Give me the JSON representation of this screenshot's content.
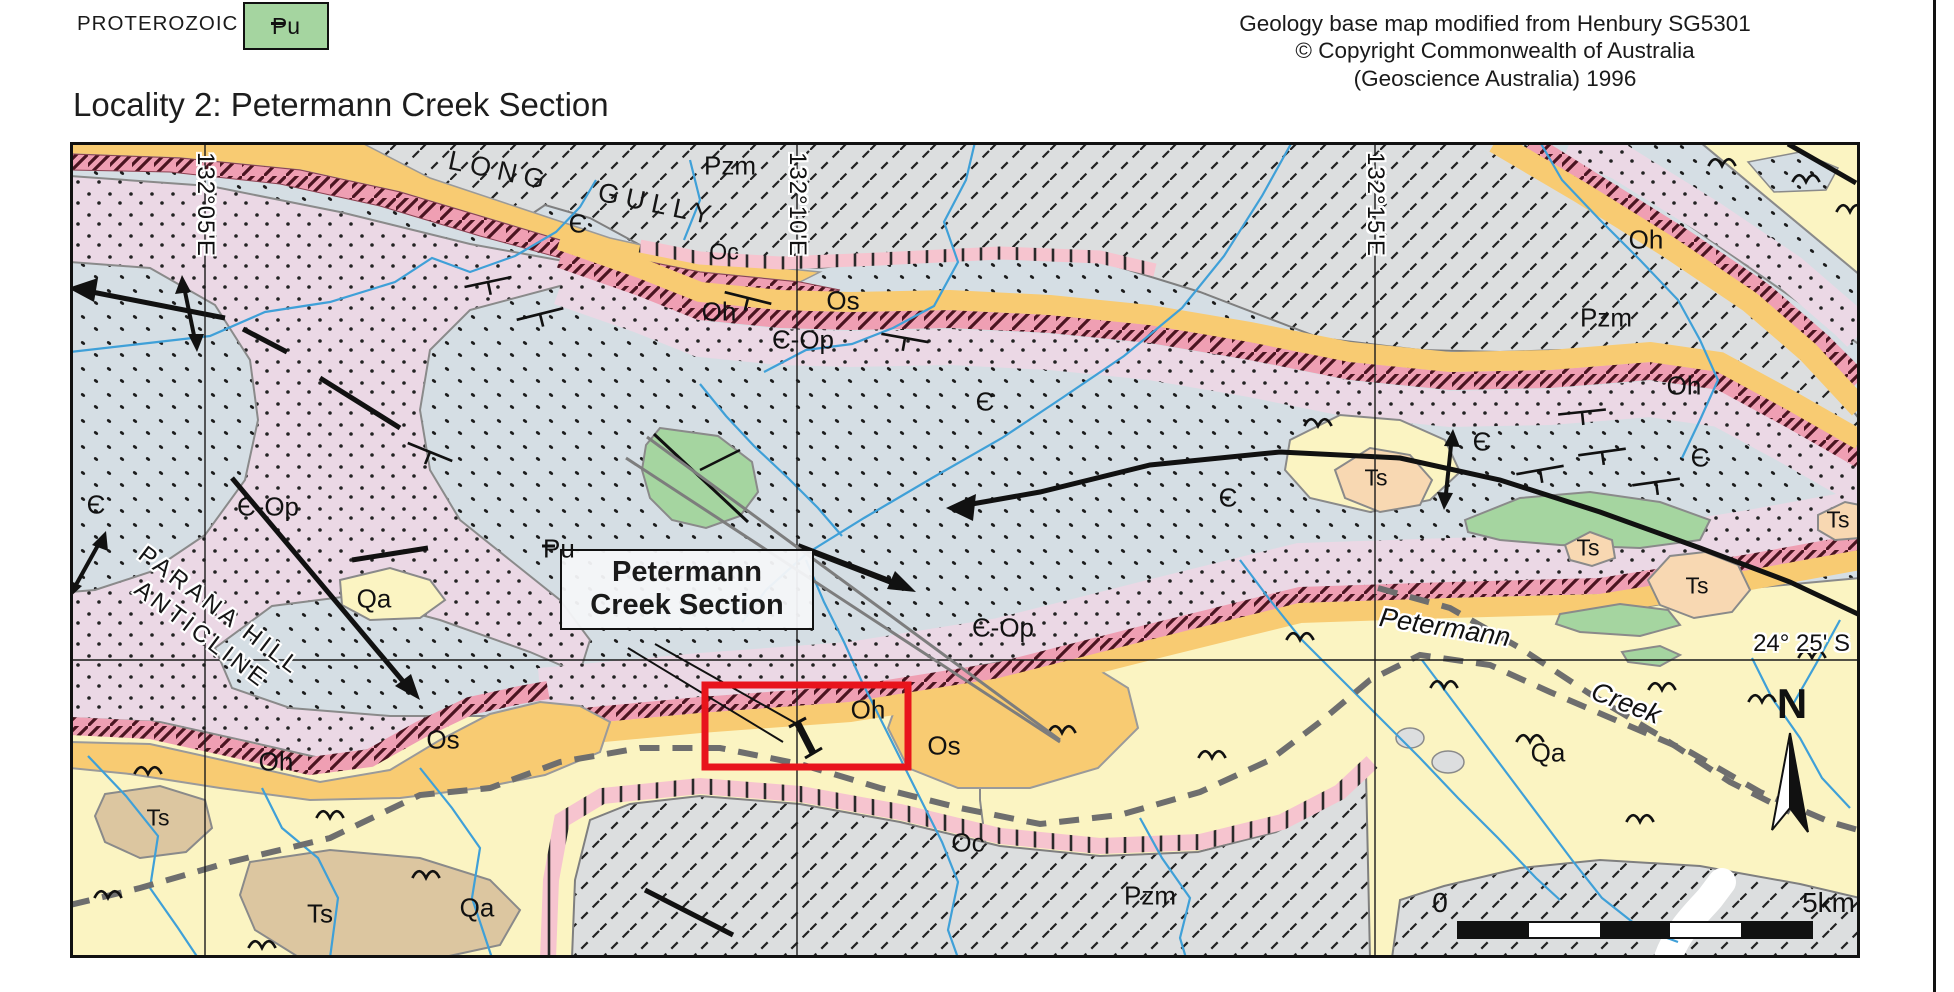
{
  "legend": {
    "era_label": "PROTEROZOIC",
    "unit_code": "Pu"
  },
  "attribution": {
    "line1": "Geology base map modified from Henbury SG5301",
    "line2": "© Copyright Commonwealth of Australia",
    "line3": "(Geoscience Australia) 1996"
  },
  "title": "Locality 2: Petermann Creek Section",
  "map": {
    "grid": {
      "lon1": "132°05'E",
      "lon2": "132°10'E",
      "lon3": "132°15'E",
      "lat1": "24° 25' S"
    },
    "place_names": {
      "long_gully": "LONG GULLY",
      "anticline_line1": "PARANA HILL",
      "anticline_line2": "ANTICLINE",
      "creek_name_1": "Petermann",
      "creek_name_2": "Creek"
    },
    "section_label": {
      "line1": "Petermann",
      "line2": "Creek Section"
    },
    "north_label": "N",
    "scale": {
      "zero": "0",
      "end": "5km"
    },
    "unit_labels": [
      {
        "t": "Pzm",
        "x": 730,
        "y": 166
      },
      {
        "t": "Oc",
        "x": 724,
        "y": 252,
        "cls": "sm"
      },
      {
        "t": "Є",
        "x": 578,
        "y": 224
      },
      {
        "t": "Oh",
        "x": 719,
        "y": 312
      },
      {
        "t": "Os",
        "x": 843,
        "y": 301
      },
      {
        "t": "Є-Op",
        "x": 803,
        "y": 340
      },
      {
        "t": "Є",
        "x": 985,
        "y": 402
      },
      {
        "t": "Є",
        "x": 96,
        "y": 505
      },
      {
        "t": "Є-Op",
        "x": 268,
        "y": 507
      },
      {
        "t": "Qa",
        "x": 374,
        "y": 599
      },
      {
        "t": "Pu",
        "x": 668,
        "y": 482,
        "cls": "pu-bar"
      },
      {
        "t": "Є-Op",
        "x": 1003,
        "y": 628
      },
      {
        "t": "Oh",
        "x": 868,
        "y": 710
      },
      {
        "t": "Os",
        "x": 944,
        "y": 746
      },
      {
        "t": "Oc",
        "x": 968,
        "y": 843
      },
      {
        "t": "Oh",
        "x": 276,
        "y": 762
      },
      {
        "t": "Os",
        "x": 443,
        "y": 740
      },
      {
        "t": "Ts",
        "x": 158,
        "y": 818,
        "cls": "sm"
      },
      {
        "t": "Ts",
        "x": 320,
        "y": 914
      },
      {
        "t": "Qa",
        "x": 477,
        "y": 908
      },
      {
        "t": "Pzm",
        "x": 1150,
        "y": 896
      },
      {
        "t": "Pzm",
        "x": 1606,
        "y": 318
      },
      {
        "t": "Oh",
        "x": 1646,
        "y": 240
      },
      {
        "t": "Є",
        "x": 1482,
        "y": 442
      },
      {
        "t": "Є",
        "x": 1700,
        "y": 458
      },
      {
        "t": "Oh",
        "x": 1684,
        "y": 386
      },
      {
        "t": "Ts",
        "x": 1376,
        "y": 478,
        "cls": "sm"
      },
      {
        "t": "Pu",
        "x": 1520,
        "y": 518,
        "cls": "pu-bar"
      },
      {
        "t": "Ts",
        "x": 1588,
        "y": 548,
        "cls": "sm"
      },
      {
        "t": "Ts",
        "x": 1697,
        "y": 586,
        "cls": "sm"
      },
      {
        "t": "Ts",
        "x": 1838,
        "y": 520,
        "cls": "sm"
      },
      {
        "t": "Qa",
        "x": 1548,
        "y": 753
      },
      {
        "t": "Є",
        "x": 1228,
        "y": 498
      }
    ]
  },
  "colors": {
    "qa": "#FBF4C2",
    "cambrian_dots": "#D5DEE4",
    "cambro_ordovician_dots": "#EBD8E5",
    "pzm_gray": "#DCDEDF",
    "oh_band": "#EF9FB3",
    "oc_band": "#F6C4CF",
    "os_band": "#F8CB72",
    "ts_tan": "#DCC6A0",
    "ts_peach": "#F8D8B2",
    "pu_green": "#A5D5A0",
    "stream_blue": "#3FA0D8",
    "road_gray": "#6E6E6E",
    "highlight_red": "#E8141C"
  }
}
